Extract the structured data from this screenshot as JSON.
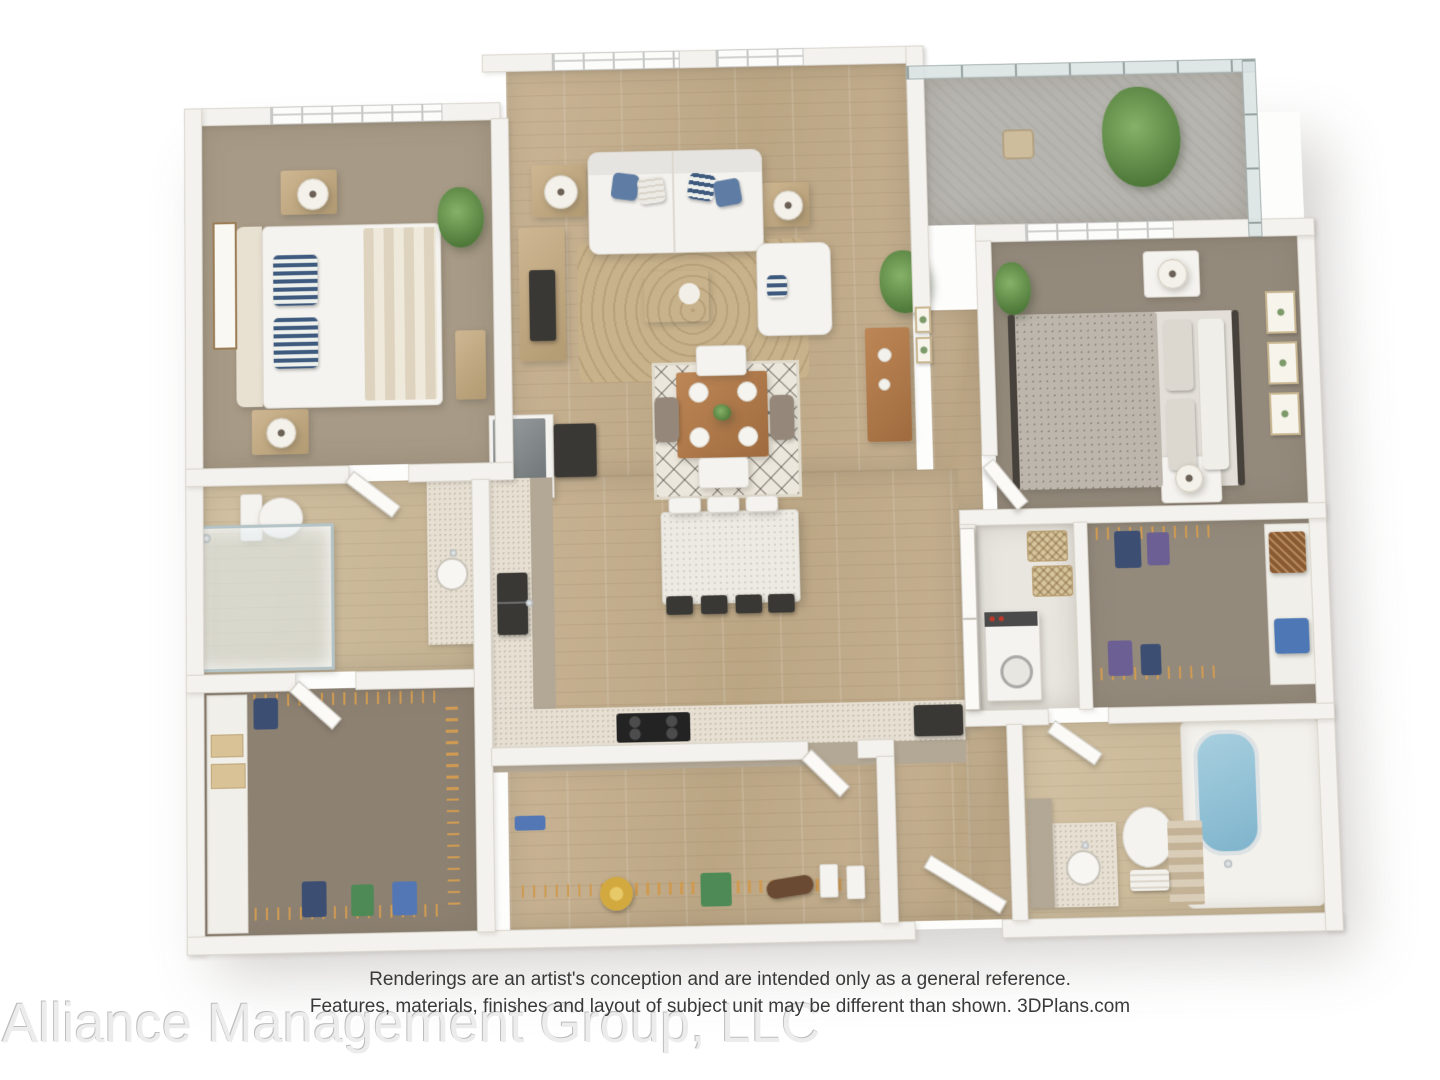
{
  "disclaimer": {
    "line1": "Renderings are an artist's conception and are intended only as a general reference.",
    "line2": "Features, materials, finishes and layout of subject unit may be different than shown. 3DPlans.com"
  },
  "watermark": {
    "text": "Alliance Management Group, LLC"
  },
  "colors": {
    "wall": "#f4f2ee",
    "wood_floor": "#c3ae8e",
    "carpet": "#a0937f",
    "closet_carpet": "#8d8172",
    "balcony_concrete": "#b7b5b0",
    "accent_pillow_blue": "#5f7da4",
    "plant_green": "#5d8c49",
    "tub_water": "#8fbdd4",
    "hanger_orange": "#cf9a52",
    "counter_speckle": "#e6dfd2",
    "dark_appliance": "#3a3834",
    "watermark_gray": "#ececec",
    "disclaimer_text": "#3a3a3a"
  }
}
